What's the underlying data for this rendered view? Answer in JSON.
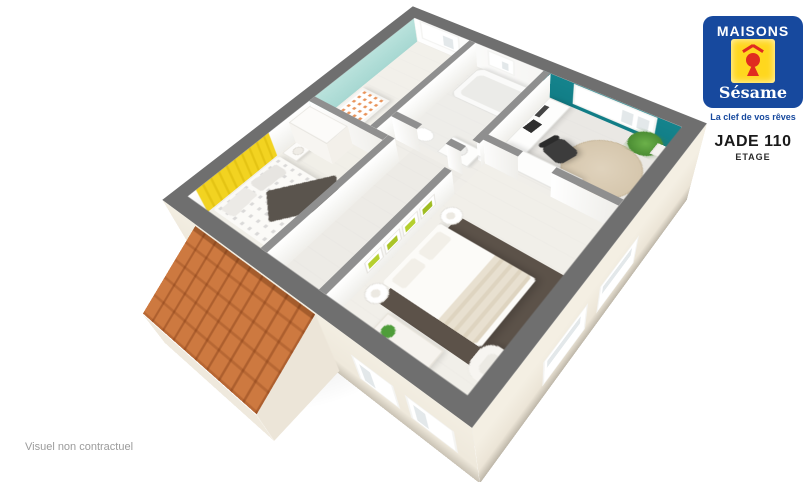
{
  "branding": {
    "name_top": "MAISONS",
    "name_bottom": "Sésame",
    "tagline": "La clef de vos rêves",
    "logo_colors": {
      "blue": "#17499e",
      "yellow": "#ffd71e",
      "red": "#e02b20"
    }
  },
  "title_block": {
    "model": "JADE 110",
    "level": "ETAGE"
  },
  "footer": {
    "disclaimer": "Visuel non contractuel"
  },
  "floorplan": {
    "view": "3d-perspective-floor-plan",
    "rooms": [
      "bedroom-yellow",
      "nursery",
      "bathroom",
      "office",
      "master-bedroom",
      "hallway"
    ],
    "colors": {
      "wall_top_exterior": "#6f6f6f",
      "wall_top_interior": "#8f8f8f",
      "exterior_render": "#efe9dc",
      "nursery_aqua_wall": "#a7d8d2",
      "bedroom_yellow_wall": "#f2d321",
      "office_teal_wall": "#15848d",
      "roof_tiles_orange": "#cd7940",
      "shelf_lime_green": "#b5cf2f",
      "master_rug_brown": "#5c5249",
      "floor_light": "#f0eee9"
    }
  }
}
